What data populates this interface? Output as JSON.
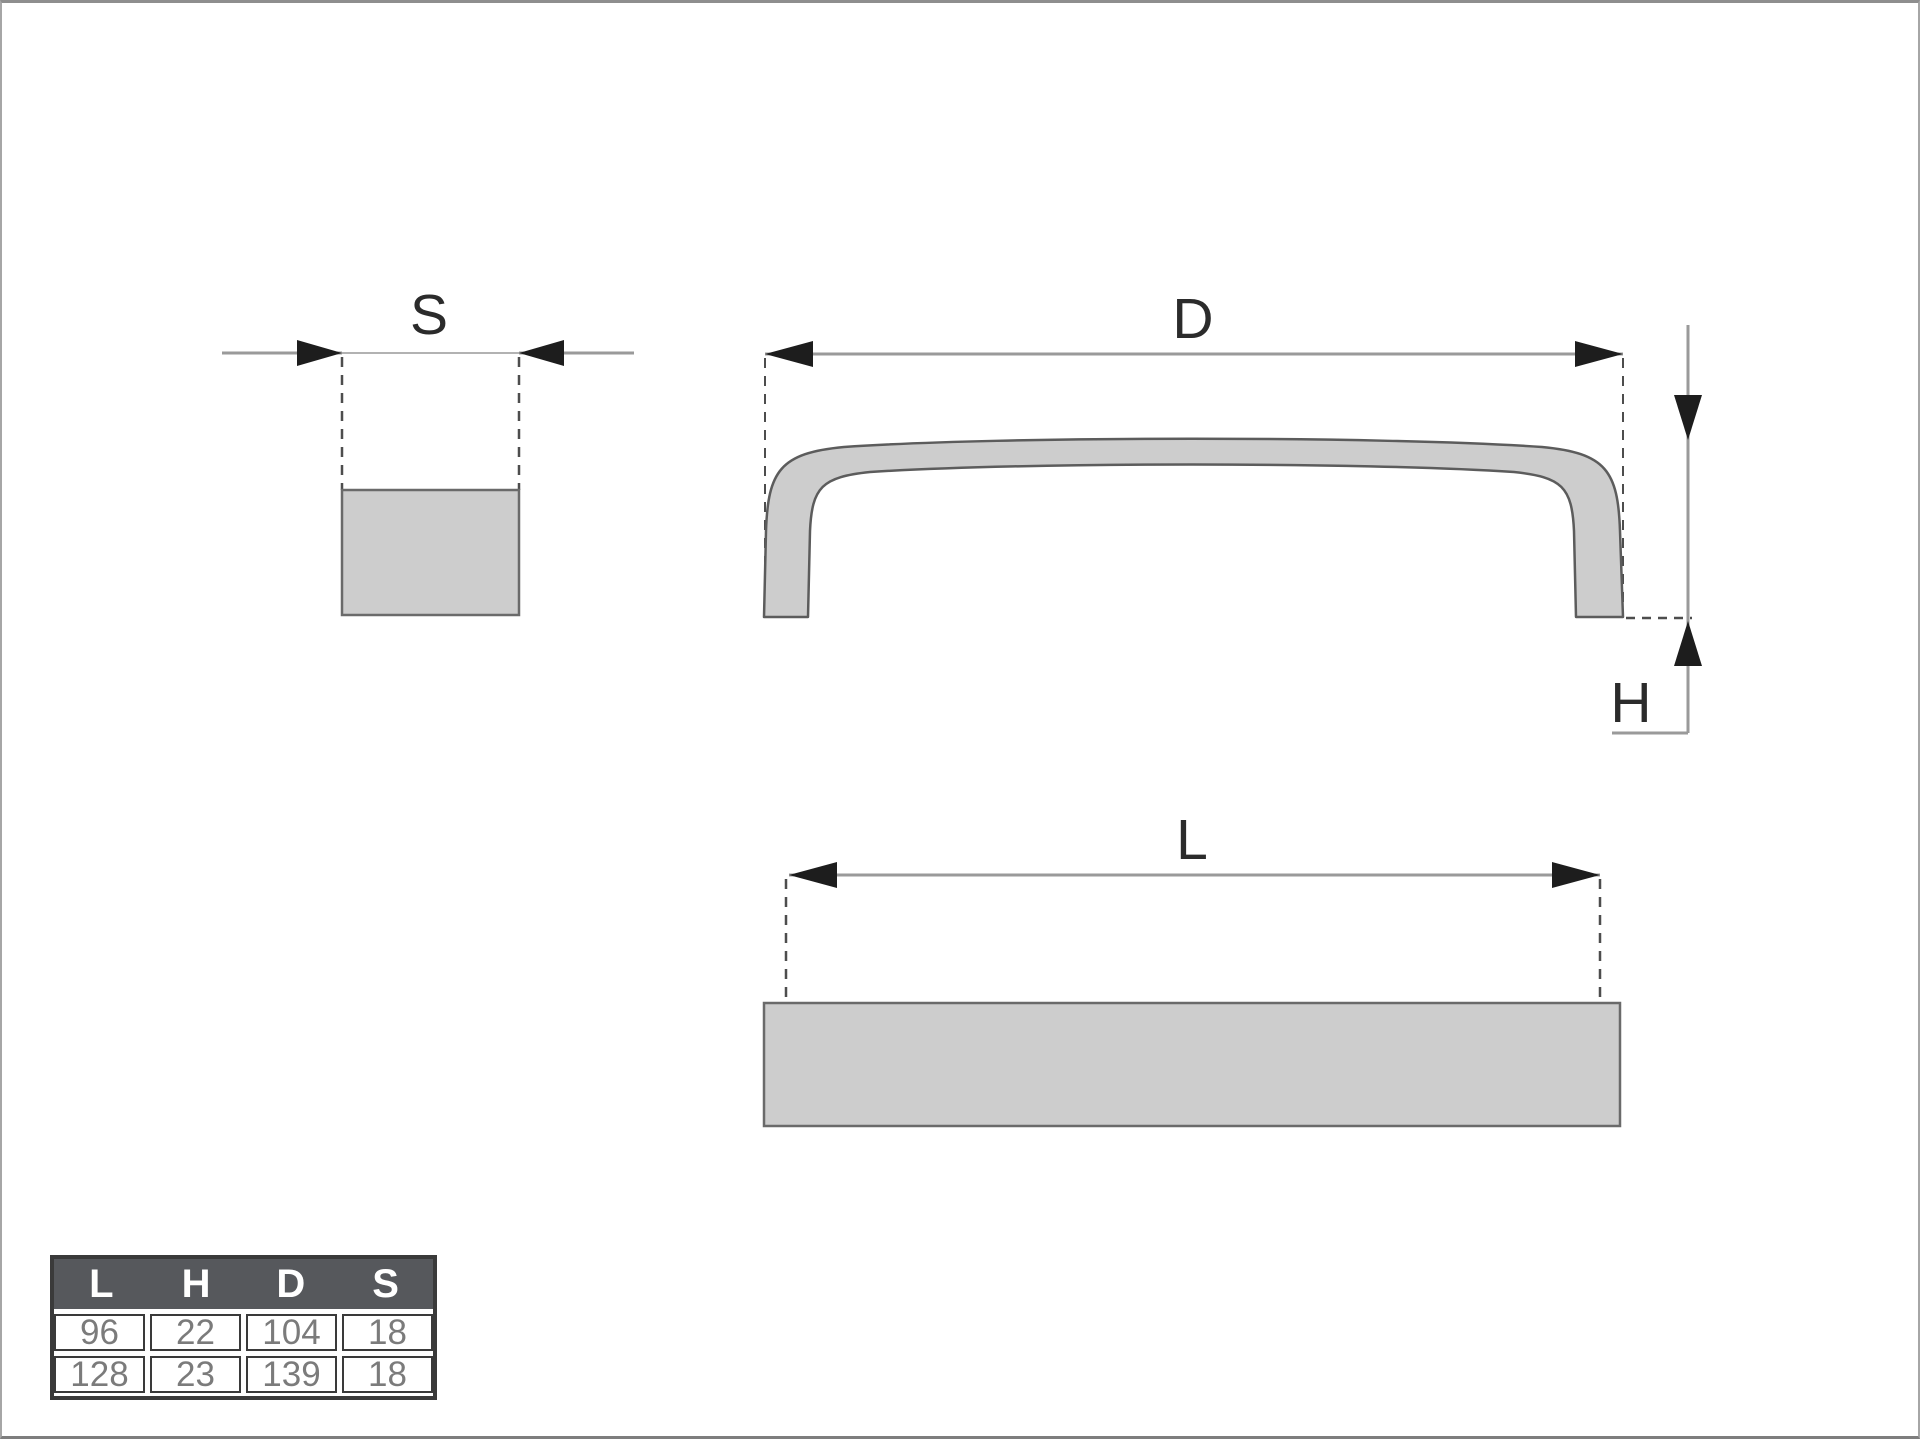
{
  "drawing": {
    "labels": {
      "s": "S",
      "d": "D",
      "h": "H",
      "l": "L"
    }
  },
  "table": {
    "headers": [
      "L",
      "H",
      "D",
      "S"
    ],
    "rows": [
      [
        "96",
        "22",
        "104",
        "18"
      ],
      [
        "128",
        "23",
        "139",
        "18"
      ]
    ]
  },
  "colors": {
    "shape_fill": "#cdcdcd",
    "shape_stroke": "#5c5c5c",
    "dim_line": "#9a9a9a",
    "dashed_line": "#4d4d4d",
    "arrowhead": "#1d1d1d",
    "label_text": "#2b2b2b",
    "table_header_bg": "#56585c",
    "table_header_text": "#ffffff",
    "table_cell_text": "#7b7b7b",
    "table_border": "#3a3a3a"
  }
}
